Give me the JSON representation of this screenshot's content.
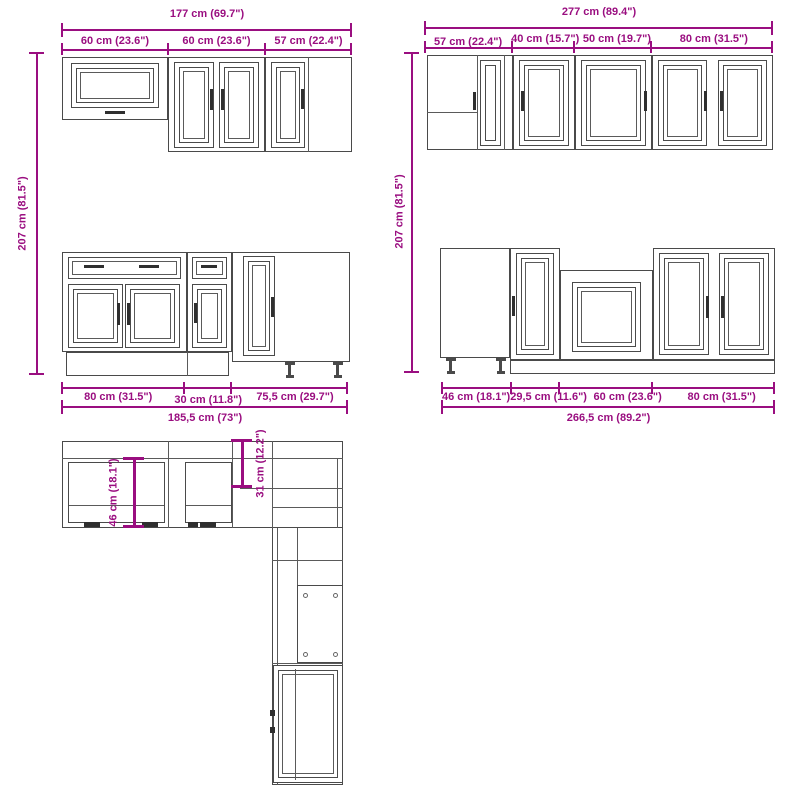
{
  "colors": {
    "dimension": "#9A0E80",
    "line": "#4a4a4a"
  },
  "elevations": {
    "wall_left": {
      "total": "177 cm (69.7\")",
      "segments": [
        "60 cm (23.6\")",
        "60 cm (23.6\")",
        "57 cm (22.4\")"
      ]
    },
    "wall_right": {
      "total": "277 cm (89.4\")",
      "segments": [
        "57 cm (22.4\")",
        "40 cm (15.7\")",
        "50 cm (19.7\")",
        "80 cm (31.5\")"
      ]
    },
    "height_left": "207 cm (81.5\")",
    "height_right": "207 cm (81.5\")",
    "base_left": {
      "segments": [
        "80 cm (31.5\")",
        "30 cm (11.8\")",
        "75,5 cm (29.7\")"
      ],
      "total": "185,5 cm (73\")"
    },
    "base_right": {
      "segments": [
        "46 cm (18.1\")",
        "29,5 cm (11.6\")",
        "60 cm (23.6\")",
        "80 cm (31.5\")"
      ],
      "total": "266,5 cm (89.2\")"
    }
  },
  "plan": {
    "base_depth": "46 cm (18.1\")",
    "wall_depth": "31 cm (12.2\")"
  }
}
